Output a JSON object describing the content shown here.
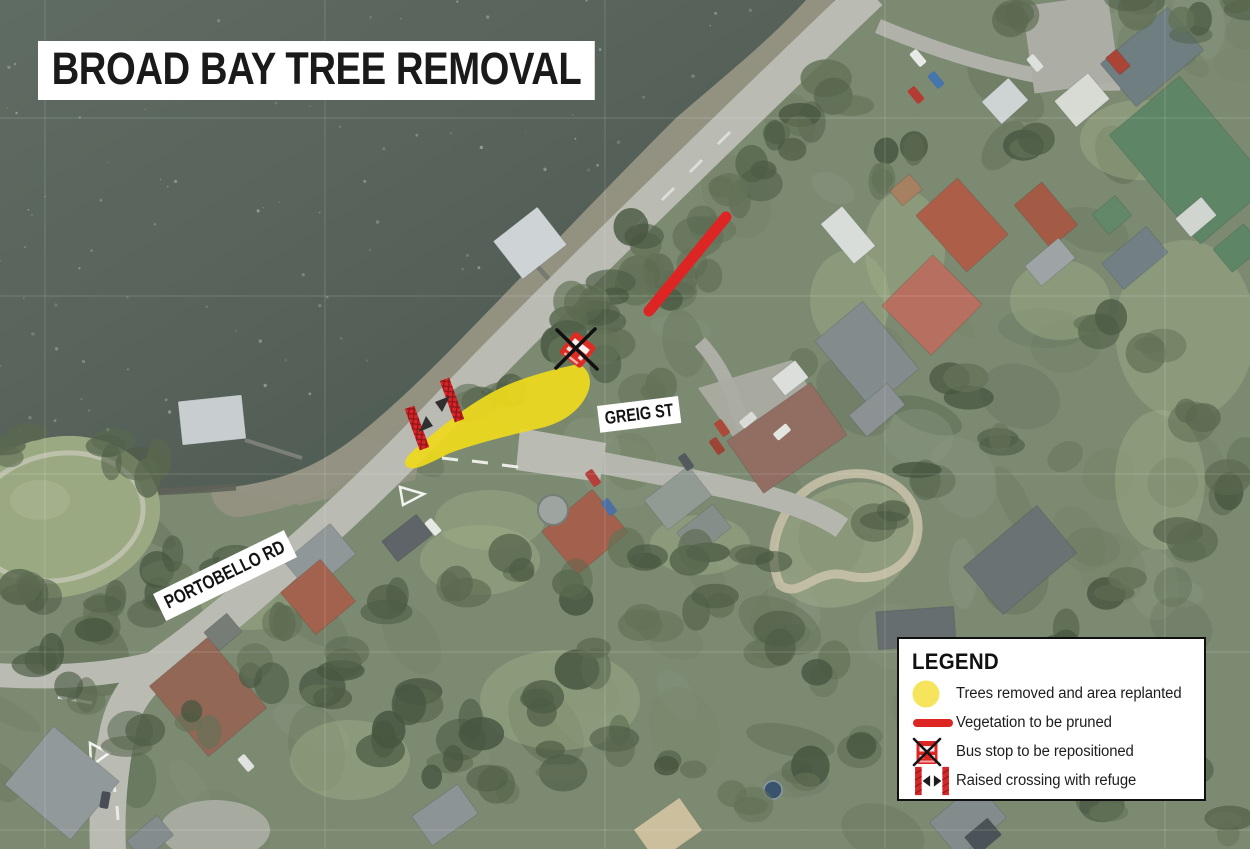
{
  "title": "BROAD BAY TREE REMOVAL",
  "map": {
    "road_labels": [
      {
        "name": "PORTOBELLO RD"
      },
      {
        "name": "GREIG ST"
      }
    ]
  },
  "legend": {
    "title": "LEGEND",
    "items": [
      {
        "icon": "tree-removal-area-icon",
        "label": "Trees removed and area replanted"
      },
      {
        "icon": "vegetation-prune-icon",
        "label": "Vegetation to be pruned"
      },
      {
        "icon": "bus-stop-icon",
        "label": "Bus stop to be repositioned"
      },
      {
        "icon": "raised-crossing-icon",
        "label": "Raised crossing with refuge"
      }
    ]
  },
  "colors": {
    "highlight_yellow": "#eed91d",
    "legend_yellow": "#f6e45c",
    "annotation_red": "#dd2524",
    "marker_ink": "#151515",
    "label_bg": "#ffffff"
  }
}
